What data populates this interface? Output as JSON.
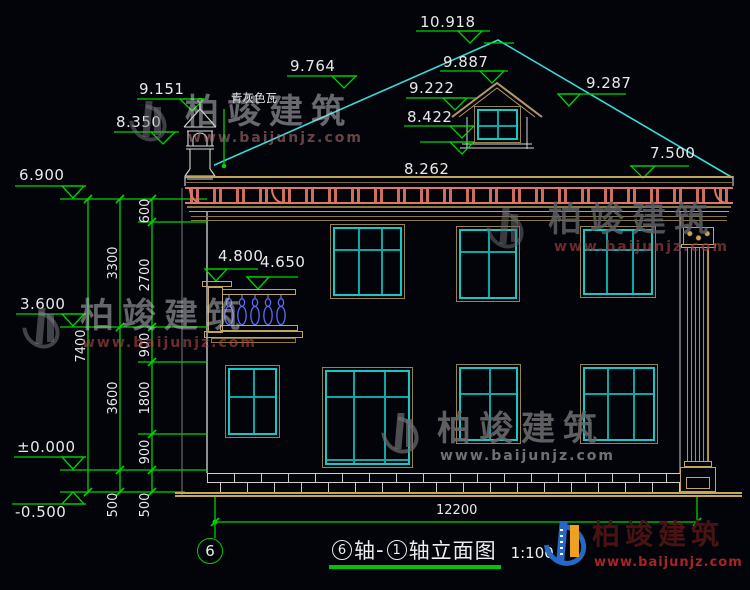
{
  "brand": {
    "name": "柏竣建筑",
    "url": "www.baijunjz.com"
  },
  "annotations": {
    "roof_tile_note": "青灰色瓦",
    "levels": {
      "ridge": "10.918",
      "dormer_ridge": "9.887",
      "dormer_eave_left": "9.222",
      "roof_right": "9.287",
      "dormer_sill": "8.422",
      "eave_top": "8.262",
      "roof_edge_right": "7.500",
      "roof_left": "9.764",
      "chimney_top": "9.151",
      "chimney_base": "8.350",
      "main_eave": "6.900",
      "balcony_cap": "4.800",
      "balcony_rail": "4.650",
      "floor2": "3.600",
      "floor1": "±0.000",
      "grade": "-0.500"
    },
    "vdims": {
      "d600": "600",
      "d2700": "2700",
      "d900a": "900",
      "d1800": "1800",
      "d900b": "900",
      "d500a": "500",
      "d3300": "3300",
      "d3600": "3600",
      "d500b": "500",
      "d7400": "7400"
    },
    "hdim_total": "12200"
  },
  "titleblock": {
    "axis_bubble": "6",
    "axis_start": "6",
    "unit_a": "轴",
    "dash": "-",
    "axis_end": "1",
    "suffix": "轴立面图",
    "scale": "1:100"
  }
}
